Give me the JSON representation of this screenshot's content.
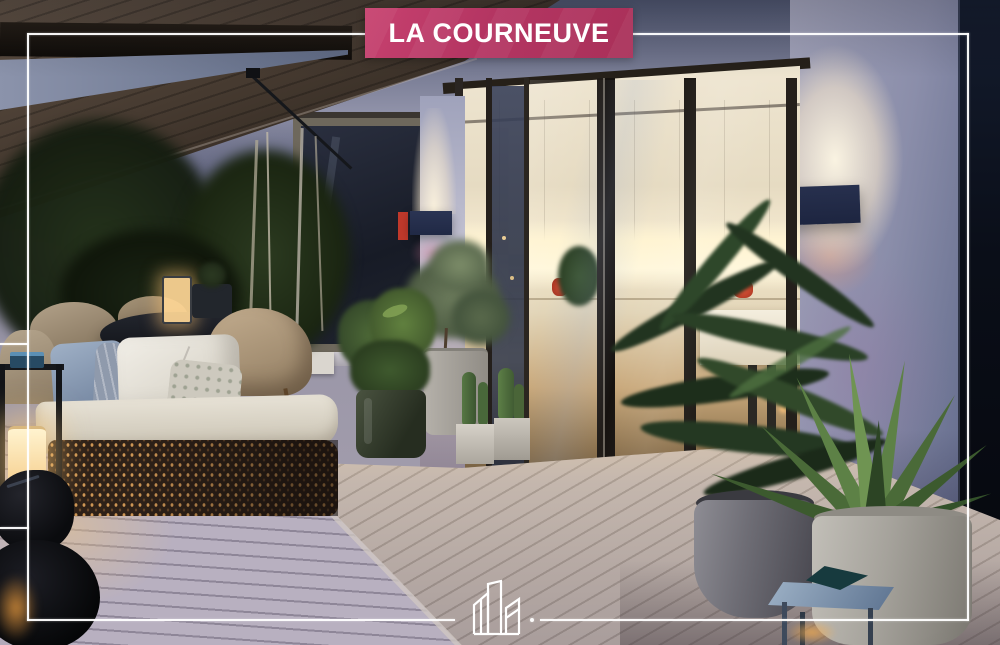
{
  "banner": {
    "label": "LA COURNEUVE",
    "bg_color": "#b43562",
    "text_color": "#ffffff"
  },
  "frame": {
    "color": "#ffffff"
  },
  "logo": {
    "icon": "buildings-skyline-icon",
    "color": "#ffffff"
  },
  "scene": {
    "type": "photograph",
    "description": "Modern apartment terrace at dusk: brown awning, outdoor lounge sofa and dining set with glowing lanterns, potted plants, light wooden deck, and a warm-lit kitchen interior behind dark-framed glass sliding doors",
    "palette": {
      "awning": "#463a30",
      "sky_wedge": "#5f6a84",
      "wall": "#8b8eaa",
      "interior": "#efe6d2",
      "interior_glow": "#fff4d2",
      "deck": "#b0a8b6",
      "foliage": "#2c3a24",
      "sconce_glow": "#fdf3de",
      "right_edge": "#0a0e18"
    }
  }
}
